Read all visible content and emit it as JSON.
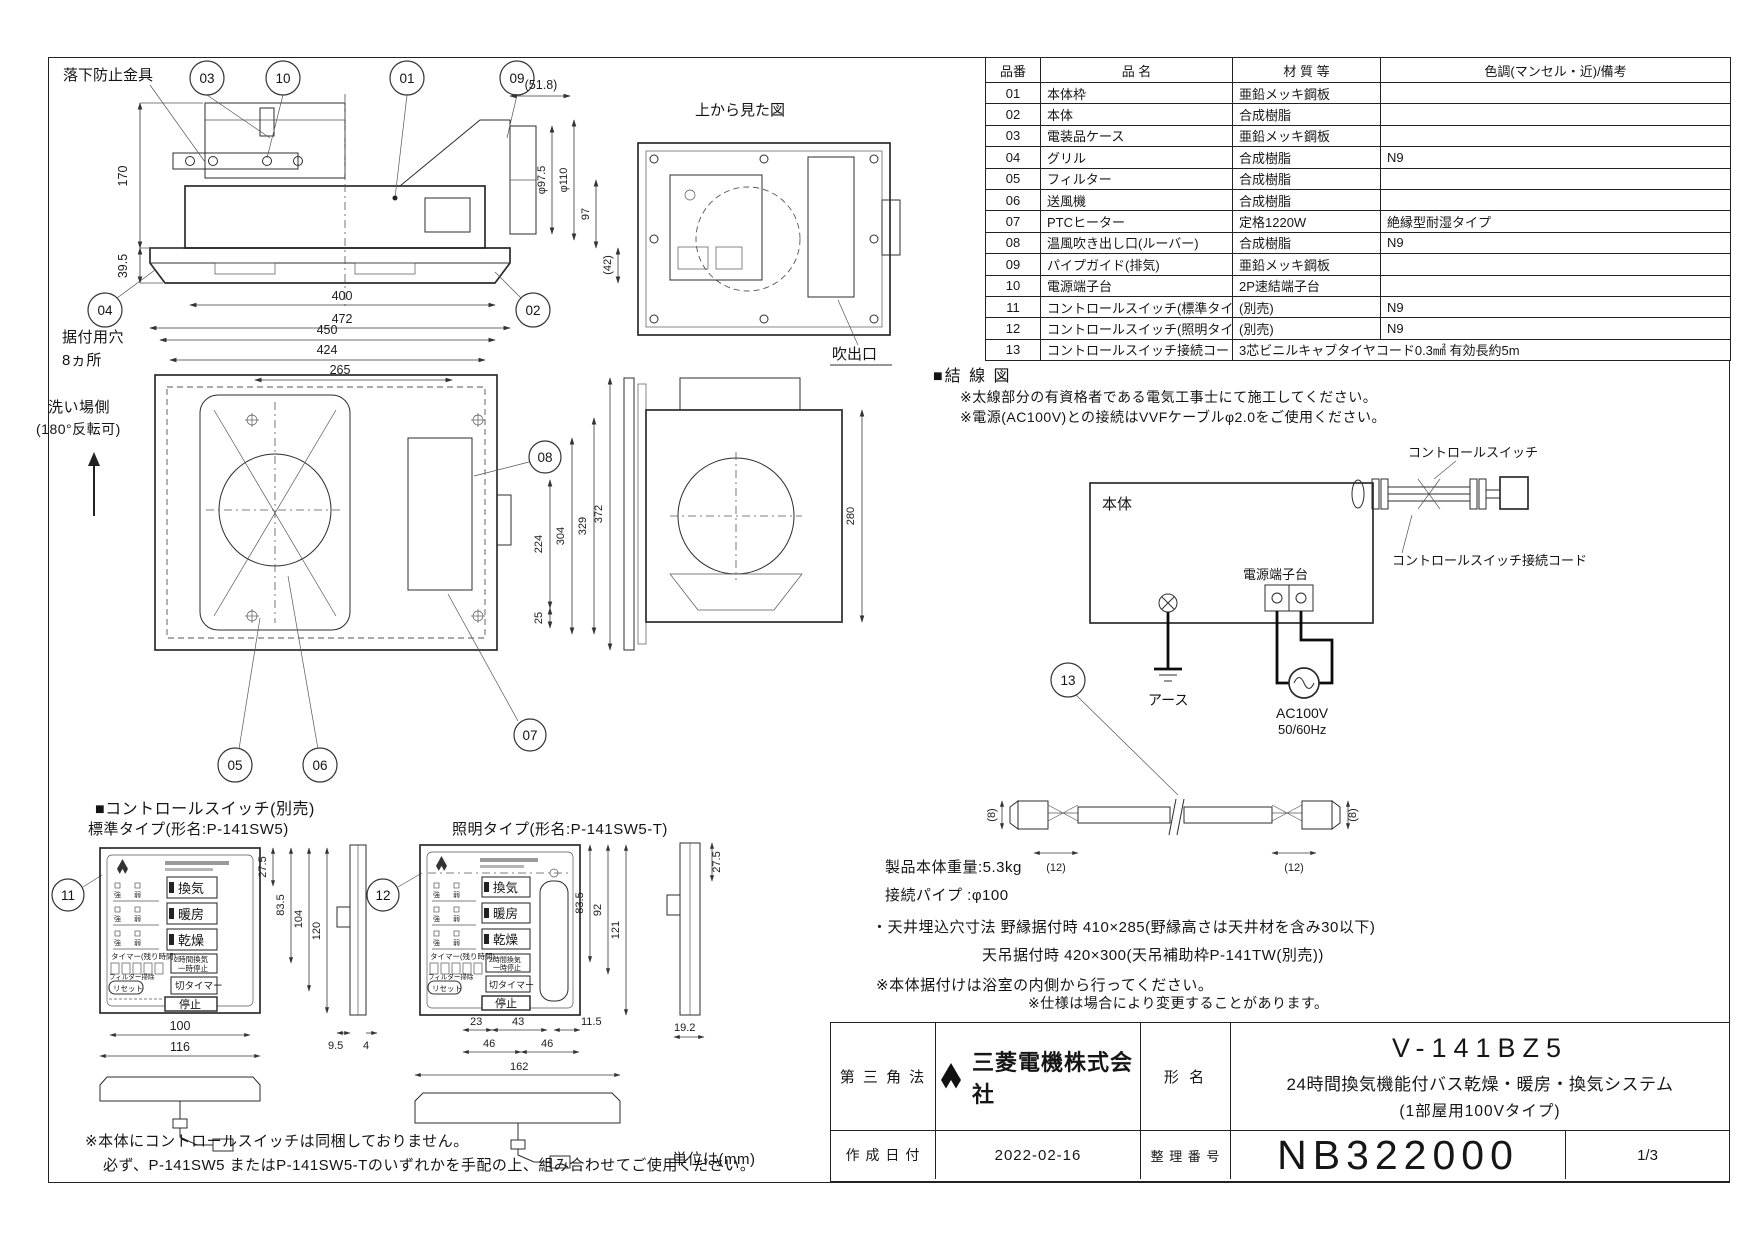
{
  "sheet": {
    "unit_note": "単位は(mm)",
    "footnote1": "※本体にコントロールスイッチは同梱しておりません。",
    "footnote2": "必ず、P-141SW5 またはP-141SW5-Tのいずれかを手配の上、組み合わせてご使用ください。"
  },
  "side_view": {
    "fall_prevention_label": "落下防止金具",
    "callout_01": "01",
    "callout_02": "02",
    "callout_03": "03",
    "callout_04": "04",
    "callout_09": "09",
    "callout_10": "10",
    "dim_170": "170",
    "dim_39_5": "39.5",
    "dim_400": "400",
    "dim_472": "472",
    "dim_51_8": "(51.8)",
    "dim_phi97_5": "φ97.5",
    "dim_phi110": "φ110",
    "dim_97": "97",
    "dim_42": "(42)"
  },
  "top_view": {
    "title": "上から見た図",
    "outlet_label": "吹出口"
  },
  "front_view": {
    "mount_hole_label_1": "据付用穴",
    "mount_hole_label_2": "8ヵ所",
    "wash_side_label_1": "洗い場側",
    "wash_side_label_2": "(180°反転可)",
    "callout_05": "05",
    "callout_06": "06",
    "callout_07": "07",
    "callout_08": "08",
    "dim_450": "450",
    "dim_424": "424",
    "dim_265": "265",
    "dim_224": "224",
    "dim_304": "304",
    "dim_329": "329",
    "dim_25": "25",
    "dim_372": "372",
    "dim_280": "280"
  },
  "parts_table": {
    "headers": [
      "品番",
      "品 名",
      "材 質 等",
      "色調(マンセル・近)/備考"
    ],
    "rows": [
      {
        "no": "01",
        "name": "本体枠",
        "material": "亜鉛メッキ鋼板",
        "remark": ""
      },
      {
        "no": "02",
        "name": "本体",
        "material": "合成樹脂",
        "remark": ""
      },
      {
        "no": "03",
        "name": "電装品ケース",
        "material": "亜鉛メッキ鋼板",
        "remark": ""
      },
      {
        "no": "04",
        "name": "グリル",
        "material": "合成樹脂",
        "remark": "N9"
      },
      {
        "no": "05",
        "name": "フィルター",
        "material": "合成樹脂",
        "remark": ""
      },
      {
        "no": "06",
        "name": "送風機",
        "material": "合成樹脂",
        "remark": ""
      },
      {
        "no": "07",
        "name": "PTCヒーター",
        "material": "定格1220W",
        "remark": "絶縁型耐湿タイプ"
      },
      {
        "no": "08",
        "name": "温風吹き出し口(ルーバー)",
        "material": "合成樹脂",
        "remark": "N9"
      },
      {
        "no": "09",
        "name": "パイプガイド(排気)",
        "material": "亜鉛メッキ鋼板",
        "remark": ""
      },
      {
        "no": "10",
        "name": "電源端子台",
        "material": "2P速結端子台",
        "remark": ""
      },
      {
        "no": "11",
        "name": "コントロールスイッチ(標準タイプ)",
        "material": "(別売)",
        "remark": "N9"
      },
      {
        "no": "12",
        "name": "コントロールスイッチ(照明タイプ)",
        "material": "(別売)",
        "remark": "N9"
      },
      {
        "no": "13",
        "name": "コントロールスイッチ接続コード",
        "material": "3芯ビニルキャブタイヤコード0.3㎟ 有効長約5m",
        "remark": null
      }
    ]
  },
  "wiring": {
    "section_title": "■結 線 図",
    "note1": "※太線部分の有資格者である電気工事士にて施工してください。",
    "note2": "※電源(AC100V)との接続はVVFケーブルφ2.0をご使用ください。",
    "body_label": "本体",
    "terminal_label": "電源端子台",
    "switch_label": "コントロールスイッチ",
    "cord_label": "コントロールスイッチ接続コード",
    "earth_label": "アース",
    "power_label": "AC100V",
    "freq_label": "50/60Hz"
  },
  "cable": {
    "callout_13": "13",
    "dim_8_left": "(8)",
    "dim_12_left": "(12)",
    "dim_12_right": "(12)",
    "dim_8_right": "(8)"
  },
  "switches": {
    "section_title": "■コントロールスイッチ(別売)",
    "standard_title": "標準タイプ(形名:P-141SW5)",
    "lighting_title": "照明タイプ(形名:P-141SW5-T)",
    "callout_11": "11",
    "callout_12": "12",
    "buttons": {
      "ventilation": "換気",
      "heating": "暖房",
      "drying": "乾燥",
      "pause1": "2時間換気",
      "pause2": "一時停止",
      "timer_label": "タイマー(残り時間)",
      "timer_off": "切タイマー",
      "reset": "リセット",
      "filter": "フィルター掃除",
      "stop": "停止",
      "ind_strong": "強",
      "ind_weak": "弱"
    },
    "standard_dims": {
      "d27_5": "27.5",
      "d83_5": "83.5",
      "d104": "104",
      "d120": "120",
      "d100": "100",
      "d116": "116",
      "d9_5": "9.5",
      "d4": "4"
    },
    "lighting_dims": {
      "d27_5": "27.5",
      "d83_5": "83.5",
      "d92": "92",
      "d121": "121",
      "d23": "23",
      "d43": "43",
      "d46a": "46",
      "d46b": "46",
      "d162": "162",
      "d11_5": "11.5",
      "d19_2": "19.2"
    }
  },
  "specs": {
    "weight": "製品本体重量:5.3kg",
    "pipe": "接続パイプ :φ100",
    "hole1": "・天井埋込穴寸法 野縁据付時 410×285(野縁高さは天井材を含み30以下)",
    "hole2": "天吊据付時 420×300(天吊補助枠P-141TW(別売))",
    "note_install": "※本体据付けは浴室の内側から行ってください。",
    "note_spec": "※仕様は場合により変更することがあります。"
  },
  "title_block": {
    "projection": "第 三 角 法",
    "company": "三菱電機株式会社",
    "model_label": "形 名",
    "model": "V-141BZ5",
    "model_desc1": "24時間換気機能付バス乾燥・暖房・換気システム",
    "model_desc2": "(1部屋用100Vタイプ)",
    "date_label": "作 成 日 付",
    "date": "2022-02-16",
    "number_label": "整 理 番 号",
    "number": "NB322000",
    "page": "1/3"
  }
}
